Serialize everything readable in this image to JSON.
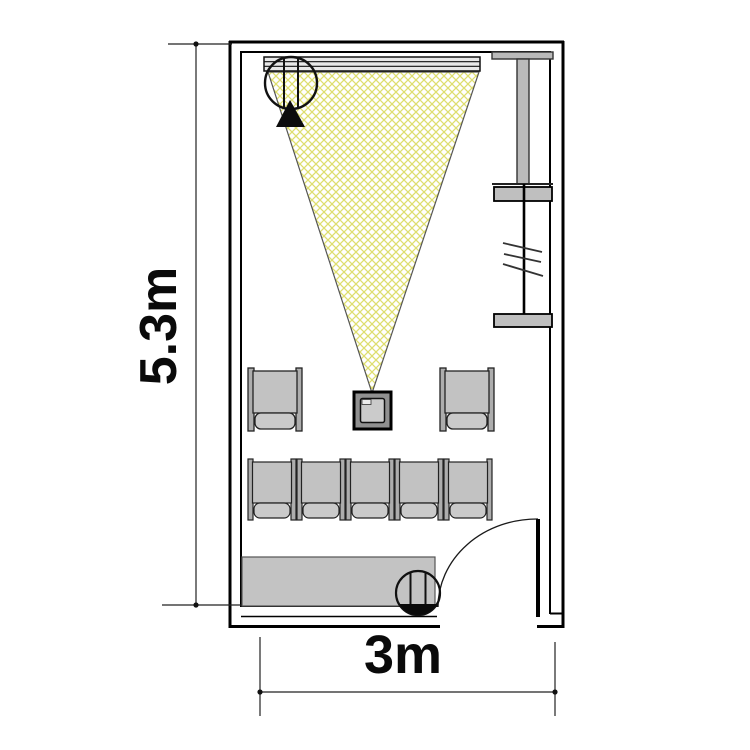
{
  "page": {
    "background": "#ffffff",
    "title": "Meeting room floor plan with projector"
  },
  "dimensions": {
    "height_label": "5.3m",
    "width_label": "3m"
  },
  "colors": {
    "beam_hatch": "#dede6e",
    "beam_edge": "#555555",
    "furniture_gray": "#c3c3c3",
    "seat_gray": "#c2c2c2",
    "backrest_gray": "#cacaca",
    "rail_gray": "#adadad",
    "panel_gray": "#bababa",
    "screen_gray": "#e8e8e8",
    "wall_black": "#000000"
  },
  "symbols": {
    "projection_screen": "projection-screen",
    "projection_beam": "projection-beam-crosshatch",
    "projector": "projector-on-table",
    "device_top": "speaker-circle-with-direction-triangle",
    "device_bottom": "speaker-circle",
    "wall_panel": "wall-mounted-panel",
    "glazing_marks": "three-diagonal-glazing-marks",
    "door": "door-leaf-with-swing-arc",
    "sideboard": "sideboard-table"
  },
  "counts": {
    "front_row_chairs": 2,
    "back_row_chairs": 5,
    "total_chairs": 7
  }
}
